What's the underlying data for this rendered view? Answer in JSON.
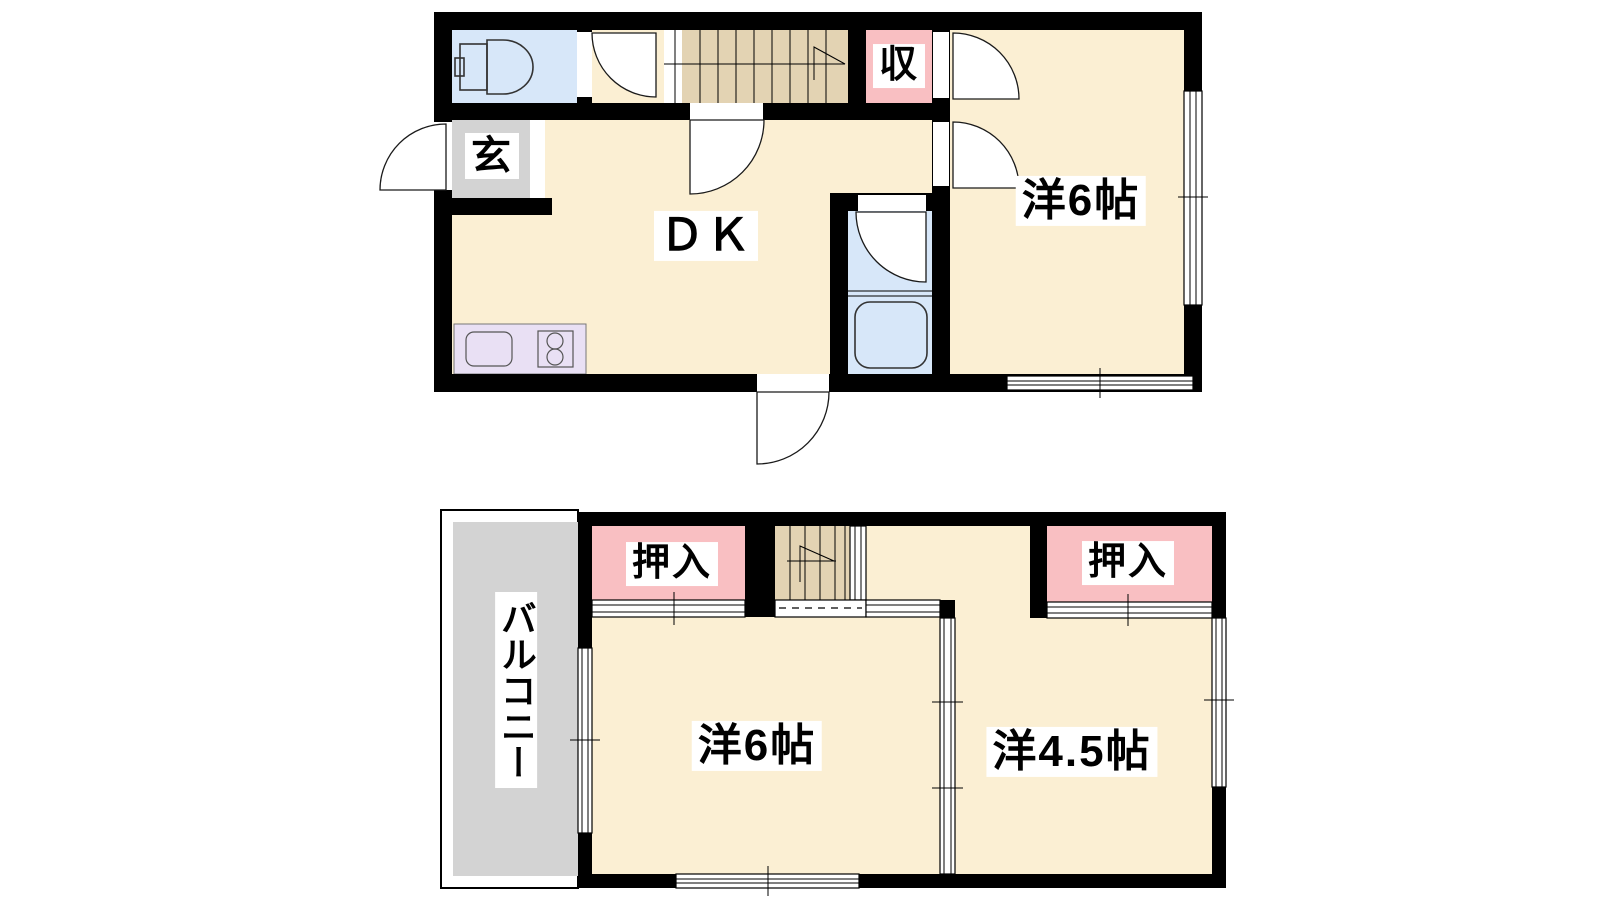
{
  "palette": {
    "wall": "#000000",
    "room_floor": "#FBEFD3",
    "stairs": "#E3D3B3",
    "closet": "#F9BFC2",
    "water": "#D7E7F9",
    "entrance_floor": "#D3D3D3",
    "balcony": "#D3D3D3",
    "kitchen": "#E9E0F4",
    "label_bg": "#FFFFFF",
    "text": "#000000"
  },
  "floor1": {
    "labels": {
      "genkan": "玄",
      "dk": "ＤＫ",
      "storage": "収",
      "western6": "洋6帖"
    }
  },
  "floor2": {
    "labels": {
      "closet_left": "押入",
      "closet_right": "押入",
      "western6": "洋6帖",
      "western45": "洋4.5帖",
      "balcony": "バルコニー"
    }
  }
}
